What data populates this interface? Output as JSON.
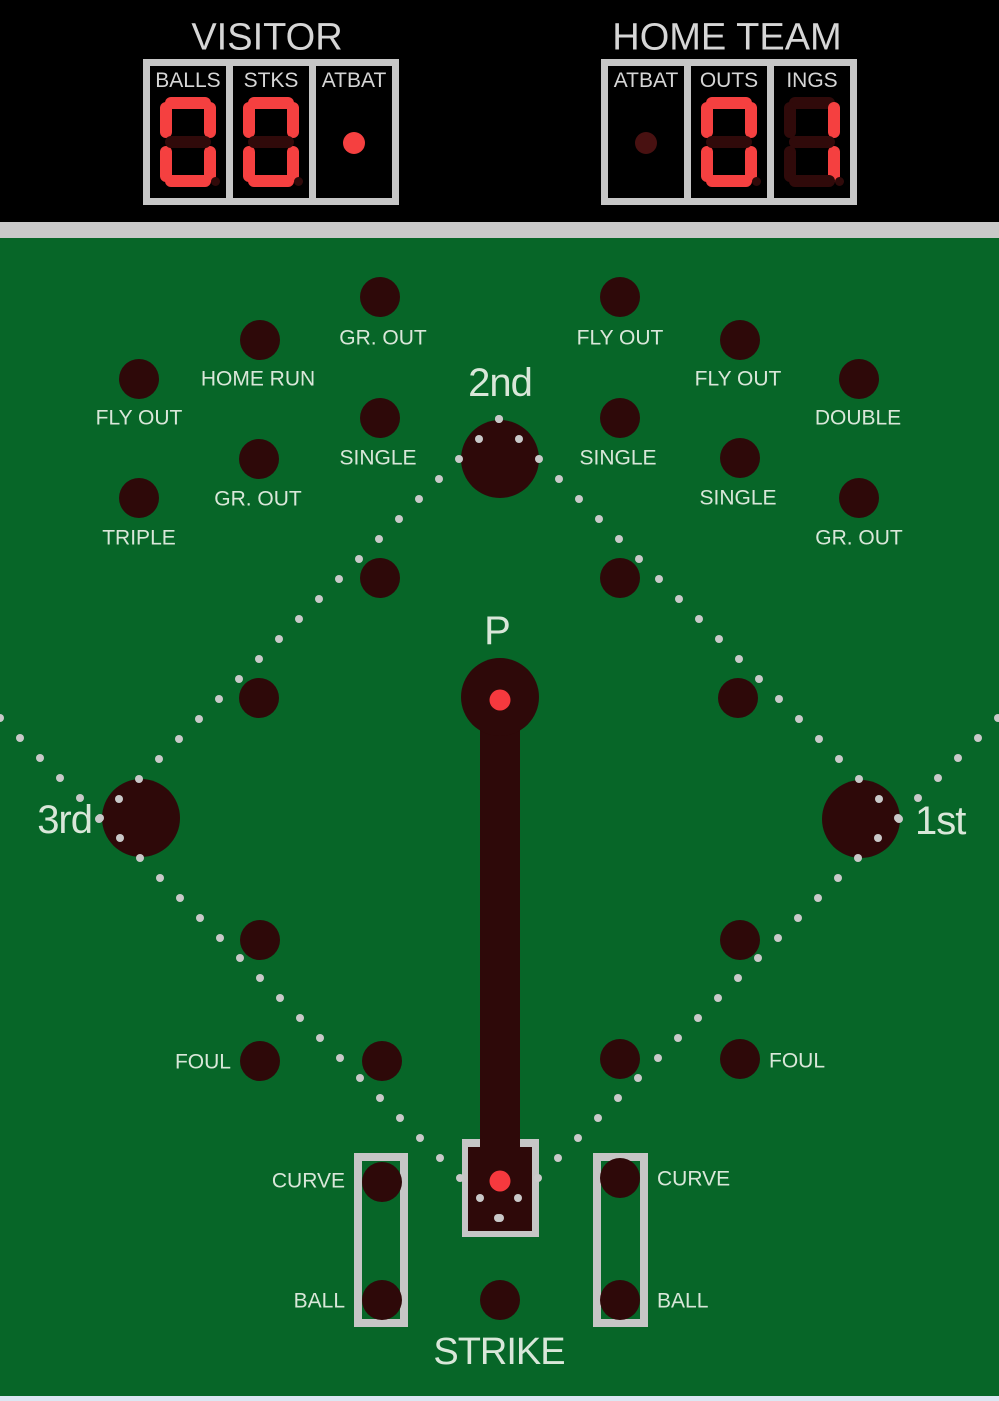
{
  "colors": {
    "field_green": "#076628",
    "hole_maroon": "#2e0909",
    "panel_black": "#000000",
    "frame_gray": "#c6c6c6",
    "band_gray": "#c9c9c9",
    "digit_red": "#f54040",
    "digit_dim": "#300a0a",
    "dim_dot_red": "#481111",
    "label_gray": "#d6d6d6",
    "field_label": "#d9e7d9",
    "path_dot": "#c9c9c9",
    "marker_red": "#f6393e",
    "bottom_line": "#dbe7f3"
  },
  "header": {
    "visitor": {
      "title": "VISITOR",
      "cells": [
        {
          "label": "BALLS",
          "type": "digit",
          "value": "0"
        },
        {
          "label": "STKS",
          "type": "digit",
          "value": "0"
        },
        {
          "label": "ATBAT",
          "type": "dot",
          "lit": true
        }
      ]
    },
    "home": {
      "title": "HOME TEAM",
      "cells": [
        {
          "label": "ATBAT",
          "type": "dot",
          "lit": false
        },
        {
          "label": "OUTS",
          "type": "digit",
          "value": "0"
        },
        {
          "label": "INGS",
          "type": "digit",
          "value": "1"
        }
      ]
    }
  },
  "field": {
    "bases": [
      {
        "id": "second-base",
        "label": "2nd",
        "x": 500,
        "y": 459,
        "lx": 500,
        "ly": 383,
        "anchor": "center"
      },
      {
        "id": "third-base",
        "label": "3rd",
        "x": 141,
        "y": 818,
        "lx": 92,
        "ly": 820,
        "anchor": "right"
      },
      {
        "id": "first-base",
        "label": "1st",
        "x": 861,
        "y": 819,
        "lx": 915,
        "ly": 821,
        "anchor": "left"
      },
      {
        "id": "pitcher-base",
        "label": "P",
        "x": 500,
        "y": 697,
        "lx": 497,
        "ly": 631,
        "anchor": "center"
      }
    ],
    "holes": [
      {
        "label": "GR. OUT",
        "x": 380,
        "y": 297,
        "lx": 383,
        "ly": 338,
        "anchor": "center"
      },
      {
        "label": "FLY OUT",
        "x": 620,
        "y": 297,
        "lx": 620,
        "ly": 338,
        "anchor": "center"
      },
      {
        "label": "HOME RUN",
        "x": 260,
        "y": 340,
        "lx": 258,
        "ly": 379,
        "anchor": "center"
      },
      {
        "label": "FLY OUT",
        "x": 740,
        "y": 340,
        "lx": 738,
        "ly": 379,
        "anchor": "center"
      },
      {
        "label": "FLY OUT",
        "x": 139,
        "y": 379,
        "lx": 139,
        "ly": 418,
        "anchor": "center"
      },
      {
        "label": "DOUBLE",
        "x": 859,
        "y": 379,
        "lx": 858,
        "ly": 418,
        "anchor": "center"
      },
      {
        "label": "SINGLE",
        "x": 380,
        "y": 418,
        "lx": 378,
        "ly": 458,
        "anchor": "center"
      },
      {
        "label": "SINGLE",
        "x": 620,
        "y": 418,
        "lx": 618,
        "ly": 458,
        "anchor": "center"
      },
      {
        "label": "GR. OUT",
        "x": 259,
        "y": 459,
        "lx": 258,
        "ly": 499,
        "anchor": "center"
      },
      {
        "label": "SINGLE",
        "x": 740,
        "y": 458,
        "lx": 738,
        "ly": 498,
        "anchor": "center"
      },
      {
        "label": "TRIPLE",
        "x": 139,
        "y": 498,
        "lx": 139,
        "ly": 538,
        "anchor": "center"
      },
      {
        "label": "GR. OUT",
        "x": 859,
        "y": 498,
        "lx": 859,
        "ly": 538,
        "anchor": "center"
      },
      {
        "label": null,
        "x": 380,
        "y": 578
      },
      {
        "label": null,
        "x": 620,
        "y": 578
      },
      {
        "label": null,
        "x": 259,
        "y": 698
      },
      {
        "label": null,
        "x": 738,
        "y": 698
      },
      {
        "label": null,
        "x": 260,
        "y": 940
      },
      {
        "label": null,
        "x": 740,
        "y": 940
      },
      {
        "label": "FOUL",
        "x": 260,
        "y": 1061,
        "lx": 231,
        "ly": 1062,
        "anchor": "right"
      },
      {
        "label": null,
        "x": 382,
        "y": 1061
      },
      {
        "label": null,
        "x": 620,
        "y": 1059
      },
      {
        "label": "FOUL",
        "x": 740,
        "y": 1059,
        "lx": 769,
        "ly": 1061,
        "anchor": "left"
      },
      {
        "label": "CURVE",
        "x": 382,
        "y": 1182,
        "lx": 345,
        "ly": 1181,
        "anchor": "right"
      },
      {
        "label": "BALL",
        "x": 382,
        "y": 1300,
        "lx": 345,
        "ly": 1301,
        "anchor": "right"
      },
      {
        "label": "CURVE",
        "x": 620,
        "y": 1178,
        "lx": 657,
        "ly": 1179,
        "anchor": "left"
      },
      {
        "label": "BALL",
        "x": 620,
        "y": 1300,
        "lx": 657,
        "ly": 1301,
        "anchor": "left"
      },
      {
        "label": "STRIKE",
        "x": 500,
        "y": 1300,
        "lx": 499,
        "ly": 1352,
        "anchor": "center",
        "size": "md"
      }
    ],
    "paths": [
      {
        "x1": 499,
        "y1": 419,
        "x2": 99,
        "y2": 819,
        "dots": 21
      },
      {
        "x1": 499,
        "y1": 419,
        "x2": 899,
        "y2": 819,
        "dots": 21
      },
      {
        "x1": 0,
        "y1": 718,
        "x2": 500,
        "y2": 1218,
        "dots": 26
      },
      {
        "x1": 998,
        "y1": 718,
        "x2": 498,
        "y2": 1218,
        "dots": 26
      }
    ],
    "markers": [
      {
        "id": "pitcher-ball-marker",
        "x": 500,
        "y": 700
      },
      {
        "id": "home-plate-ball-marker",
        "x": 500,
        "y": 1181
      }
    ],
    "pitcher_lane": {
      "x": 480,
      "y": 697,
      "w": 40,
      "h": 505
    },
    "home_plate": {
      "outer": {
        "x": 462,
        "y": 1139,
        "w": 77,
        "h": 98
      },
      "inner": {
        "x": 468,
        "y": 1147,
        "w": 64,
        "h": 84
      }
    },
    "curve_boxes": [
      {
        "x": 354,
        "y": 1153,
        "w": 54,
        "h": 174
      },
      {
        "x": 593,
        "y": 1153,
        "w": 55,
        "h": 174
      }
    ]
  }
}
